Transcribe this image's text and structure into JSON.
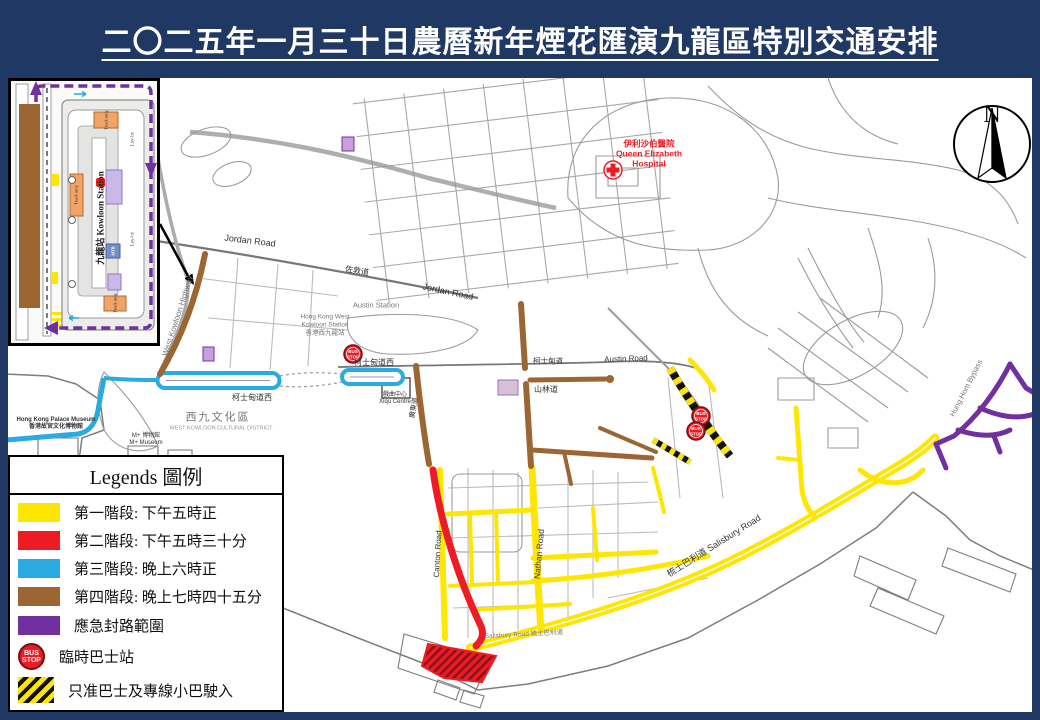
{
  "title": "二〇二五年一月三十日農曆新年煙花匯演九龍區特別交通安排",
  "colors": {
    "background_navy": "#1F3864",
    "phase1_yellow": "#FFE600",
    "phase2_red": "#ED1C24",
    "phase3_blue": "#29ABE2",
    "phase4_brown": "#9C6632",
    "emergency_purple": "#7030A0"
  },
  "legend": {
    "title": "Legends 圖例",
    "items": [
      {
        "swatch": "yellow",
        "label": "第一階段: 下午五時正"
      },
      {
        "swatch": "red",
        "label": "第二階段: 下午五時三十分"
      },
      {
        "swatch": "blue",
        "label": "第三階段: 晚上六時正"
      },
      {
        "swatch": "brown",
        "label": "第四階段: 晚上七時四十五分"
      },
      {
        "swatch": "purple",
        "label": "應急封路範圍"
      },
      {
        "swatch": "bus-stop",
        "label": "臨時巴士站"
      },
      {
        "swatch": "hatched",
        "label": "只准巴士及專線小巴駛入"
      }
    ]
  },
  "bus_stop": {
    "line1": "BUS",
    "line2": "STOP"
  },
  "compass": {
    "n": "N"
  },
  "inset": {
    "station": "九龍站 Kowloon Station",
    "truck_only": "Truck only",
    "lay_by": "Lay-by",
    "mtr": "MTR"
  },
  "map": {
    "labels": [
      {
        "text": "Jordan Road"
      },
      {
        "text": "佐敦道"
      },
      {
        "text": "Jordan Road"
      },
      {
        "text": "West Kowloon Highway"
      },
      {
        "text": "Austin Station"
      },
      {
        "text": "Hong Kong West\nKowloon Station\n香港西九龍站"
      },
      {
        "text": "柯士甸道西"
      },
      {
        "text": "柯士甸道西"
      },
      {
        "text": "柯士甸道"
      },
      {
        "text": "Austin Road"
      },
      {
        "text": "山林道"
      },
      {
        "text": "Nathan Road"
      },
      {
        "text": "Canton Road"
      },
      {
        "text": "梳士巴利道  Salisbury Road"
      },
      {
        "text": "Salisbury Road 梳士巴利道"
      },
      {
        "text": "西九文化區"
      },
      {
        "text": "WEST KOWLOON CULTURAL DISTRICT"
      },
      {
        "text": "Hong Kong Palace Museum\n香港故宮文化博物館"
      },
      {
        "text": "M+ 博物館\nM+ Museum"
      },
      {
        "text": "戲曲中心\nXiqu Centre"
      },
      {
        "text": "Hung Hom Bypass"
      },
      {
        "text": "伊利沙伯醫院\nQueen Elizabeth\nHospital"
      },
      {
        "text": "廣東道"
      }
    ]
  }
}
